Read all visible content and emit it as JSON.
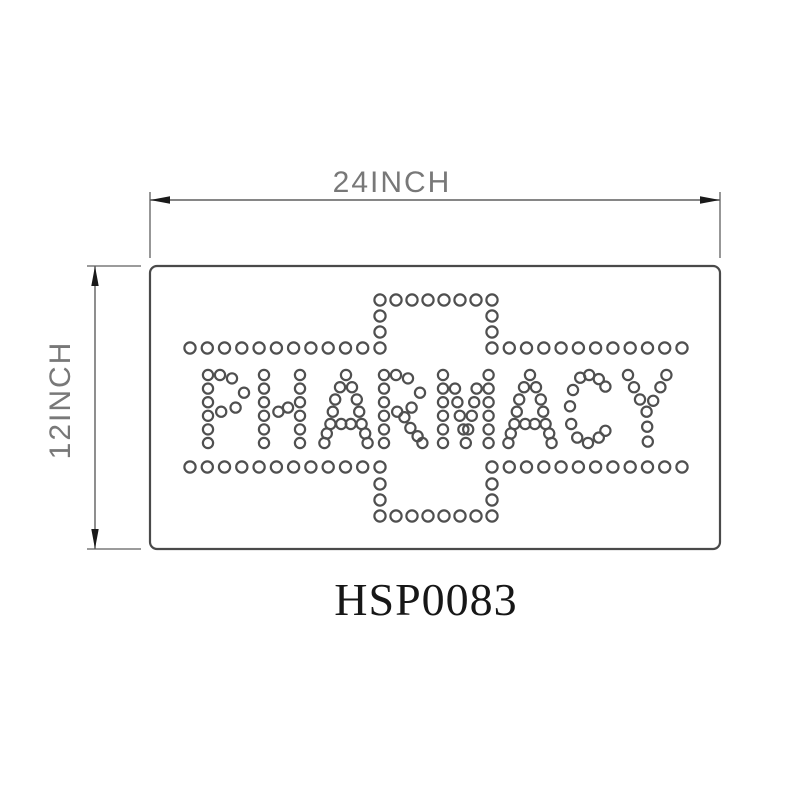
{
  "labels": {
    "width": "24INCH",
    "height": "12INCH",
    "product_code": "HSP0083",
    "sign_text": "PHARMACY"
  },
  "colors": {
    "background": "#ffffff",
    "line": "#4a4a4a",
    "dim_line": "#5f5f5f",
    "arrow": "#1a1a1a",
    "dot": "#4f4f4f",
    "dim_text": "#787878",
    "code_text": "#171717"
  },
  "dot_art": {
    "dot_radius_outline": 5.6,
    "dot_radius_letters": 5.1,
    "dot_stroke_width": 2.2,
    "letter_cell_x": 12,
    "letter_cell_y": 13.6,
    "letter_top_y": 375,
    "cross_segments": [
      [
        380,
        300,
        492,
        300,
        8
      ],
      [
        380,
        316,
        380,
        332,
        2
      ],
      [
        492,
        316,
        492,
        332,
        2
      ],
      [
        190,
        348,
        380,
        348,
        12
      ],
      [
        492,
        348,
        682,
        348,
        12
      ],
      [
        190,
        467,
        380,
        467,
        12
      ],
      [
        492,
        467,
        682,
        467,
        12
      ],
      [
        380,
        484,
        380,
        500,
        2
      ],
      [
        492,
        484,
        492,
        500,
        2
      ],
      [
        380,
        516,
        492,
        516,
        8
      ]
    ],
    "letters": [
      {
        "char": "P",
        "x": 208,
        "dots": [
          [
            0,
            0
          ],
          [
            0,
            1
          ],
          [
            0,
            2
          ],
          [
            0,
            3
          ],
          [
            0,
            4
          ],
          [
            0,
            5
          ],
          [
            1,
            0
          ],
          [
            2,
            0.25
          ],
          [
            3,
            1.3
          ],
          [
            2.3,
            2.4
          ],
          [
            1.1,
            2.7
          ]
        ]
      },
      {
        "char": "H",
        "x": 264,
        "dots": [
          [
            0,
            0
          ],
          [
            0,
            1
          ],
          [
            0,
            2
          ],
          [
            0,
            3
          ],
          [
            0,
            4
          ],
          [
            0,
            5
          ],
          [
            3,
            0
          ],
          [
            3,
            1
          ],
          [
            3,
            2
          ],
          [
            3,
            3
          ],
          [
            3,
            4
          ],
          [
            3,
            5
          ],
          [
            1.2,
            2.7
          ],
          [
            2,
            2.4
          ]
        ]
      },
      {
        "char": "A",
        "x": 322,
        "dots": [
          [
            2,
            0
          ],
          [
            1.5,
            0.9
          ],
          [
            2.5,
            0.9
          ],
          [
            1.1,
            1.8
          ],
          [
            2.9,
            1.8
          ],
          [
            0.9,
            2.7
          ],
          [
            3.1,
            2.7
          ],
          [
            0.7,
            3.6
          ],
          [
            1.6,
            3.6
          ],
          [
            2.4,
            3.6
          ],
          [
            3.3,
            3.6
          ],
          [
            0.4,
            4.3
          ],
          [
            3.6,
            4.3
          ],
          [
            0.2,
            5
          ],
          [
            3.8,
            5
          ]
        ]
      },
      {
        "char": "R",
        "x": 384,
        "dots": [
          [
            0,
            0
          ],
          [
            0,
            1
          ],
          [
            0,
            2
          ],
          [
            0,
            3
          ],
          [
            0,
            4
          ],
          [
            0,
            5
          ],
          [
            1,
            0
          ],
          [
            2,
            0.25
          ],
          [
            3,
            1.3
          ],
          [
            2.3,
            2.4
          ],
          [
            1.1,
            2.7
          ],
          [
            1.7,
            3.1
          ],
          [
            2.2,
            3.9
          ],
          [
            2.8,
            4.5
          ],
          [
            3.2,
            5
          ]
        ]
      },
      {
        "char": "M",
        "x": 443,
        "dots": [
          [
            0,
            0
          ],
          [
            3.8,
            0
          ],
          [
            0,
            1
          ],
          [
            1,
            1
          ],
          [
            2.8,
            1
          ],
          [
            3.8,
            1
          ],
          [
            0,
            2
          ],
          [
            1.2,
            2
          ],
          [
            2.6,
            2
          ],
          [
            3.8,
            2
          ],
          [
            0,
            3
          ],
          [
            1.4,
            3
          ],
          [
            2.4,
            3
          ],
          [
            3.8,
            3
          ],
          [
            0,
            4
          ],
          [
            1.7,
            4
          ],
          [
            2.1,
            4
          ],
          [
            3.8,
            4
          ],
          [
            0,
            5
          ],
          [
            1.9,
            5
          ],
          [
            3.8,
            5
          ]
        ]
      },
      {
        "char": "A",
        "x": 506,
        "dots": [
          [
            2,
            0
          ],
          [
            1.5,
            0.9
          ],
          [
            2.5,
            0.9
          ],
          [
            1.1,
            1.8
          ],
          [
            2.9,
            1.8
          ],
          [
            0.9,
            2.7
          ],
          [
            3.1,
            2.7
          ],
          [
            0.7,
            3.6
          ],
          [
            1.6,
            3.6
          ],
          [
            2.4,
            3.6
          ],
          [
            3.3,
            3.6
          ],
          [
            0.4,
            4.3
          ],
          [
            3.6,
            4.3
          ],
          [
            0.2,
            5
          ],
          [
            3.8,
            5
          ]
        ]
      },
      {
        "char": "C",
        "x": 570,
        "dots": [
          [
            1.6,
            0
          ],
          [
            0.85,
            0.2
          ],
          [
            2.4,
            0.3
          ],
          [
            2.95,
            0.85
          ],
          [
            0.25,
            1.1
          ],
          [
            0,
            2.3
          ],
          [
            0.1,
            3.6
          ],
          [
            0.6,
            4.6
          ],
          [
            1.5,
            5
          ],
          [
            2.4,
            4.6
          ],
          [
            2.95,
            4.1
          ]
        ]
      },
      {
        "char": "Y",
        "x": 628,
        "dots": [
          [
            0,
            0
          ],
          [
            3.2,
            0
          ],
          [
            0.5,
            0.9
          ],
          [
            2.7,
            0.9
          ],
          [
            1.0,
            1.8
          ],
          [
            2.1,
            1.9
          ],
          [
            1.55,
            2.7
          ],
          [
            1.6,
            3.8
          ],
          [
            1.65,
            4.9
          ]
        ]
      }
    ]
  },
  "drawing": {
    "panel": {
      "x": 150,
      "y": 266,
      "width": 570,
      "height": 283,
      "corner_radius": 7
    },
    "h_dim_y": 200,
    "v_dim_x": 95
  }
}
